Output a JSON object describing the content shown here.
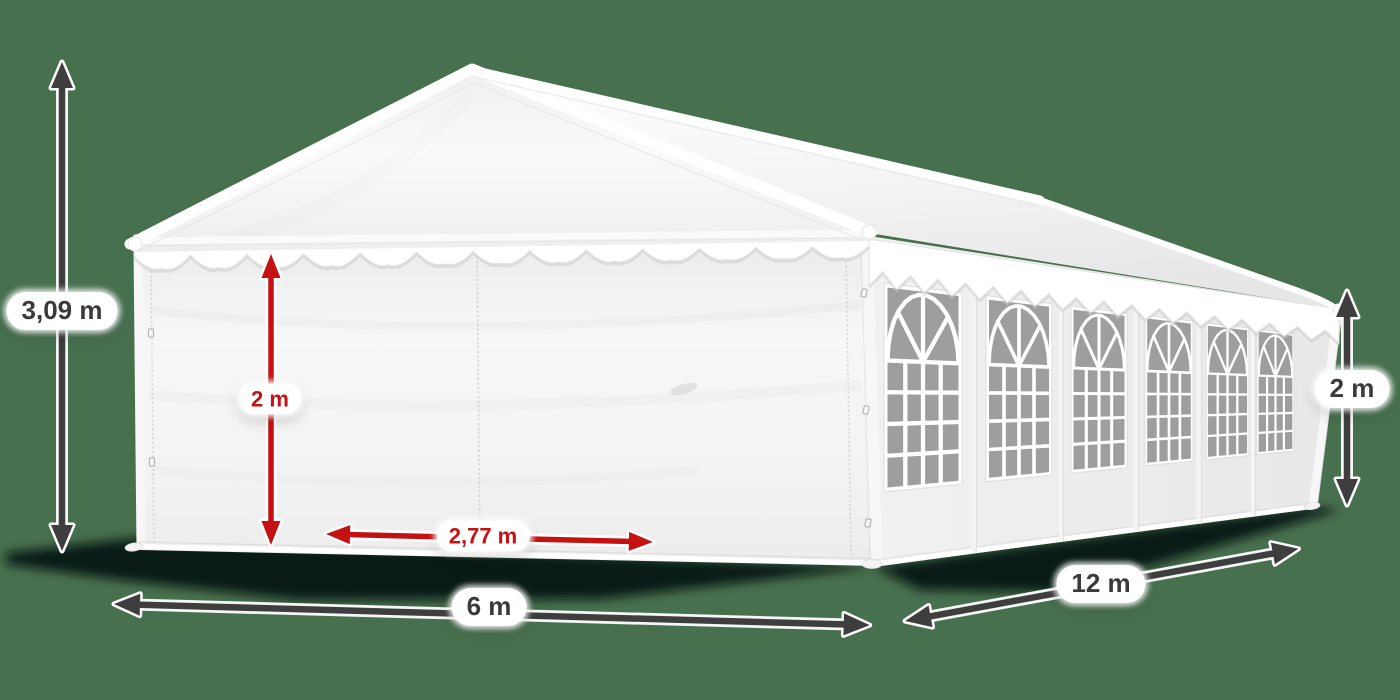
{
  "tent": {
    "side_window_count": 6
  },
  "labels": {
    "total_height": "3,09 m",
    "wall_height": "2 m",
    "entrance_width": "2,77 m",
    "width": "6 m",
    "length": "12 m",
    "side_height": "2 m"
  },
  "colors": {
    "background": "#47704f",
    "arrow_dark": "#3e3e3e",
    "arrow_red": "#c41111",
    "label_text_dark": "#3a3a3a",
    "label_text_red": "#c41111",
    "tent_white": "#ffffff",
    "window_glass": "#9e9e9e",
    "shadow": "#041008"
  }
}
